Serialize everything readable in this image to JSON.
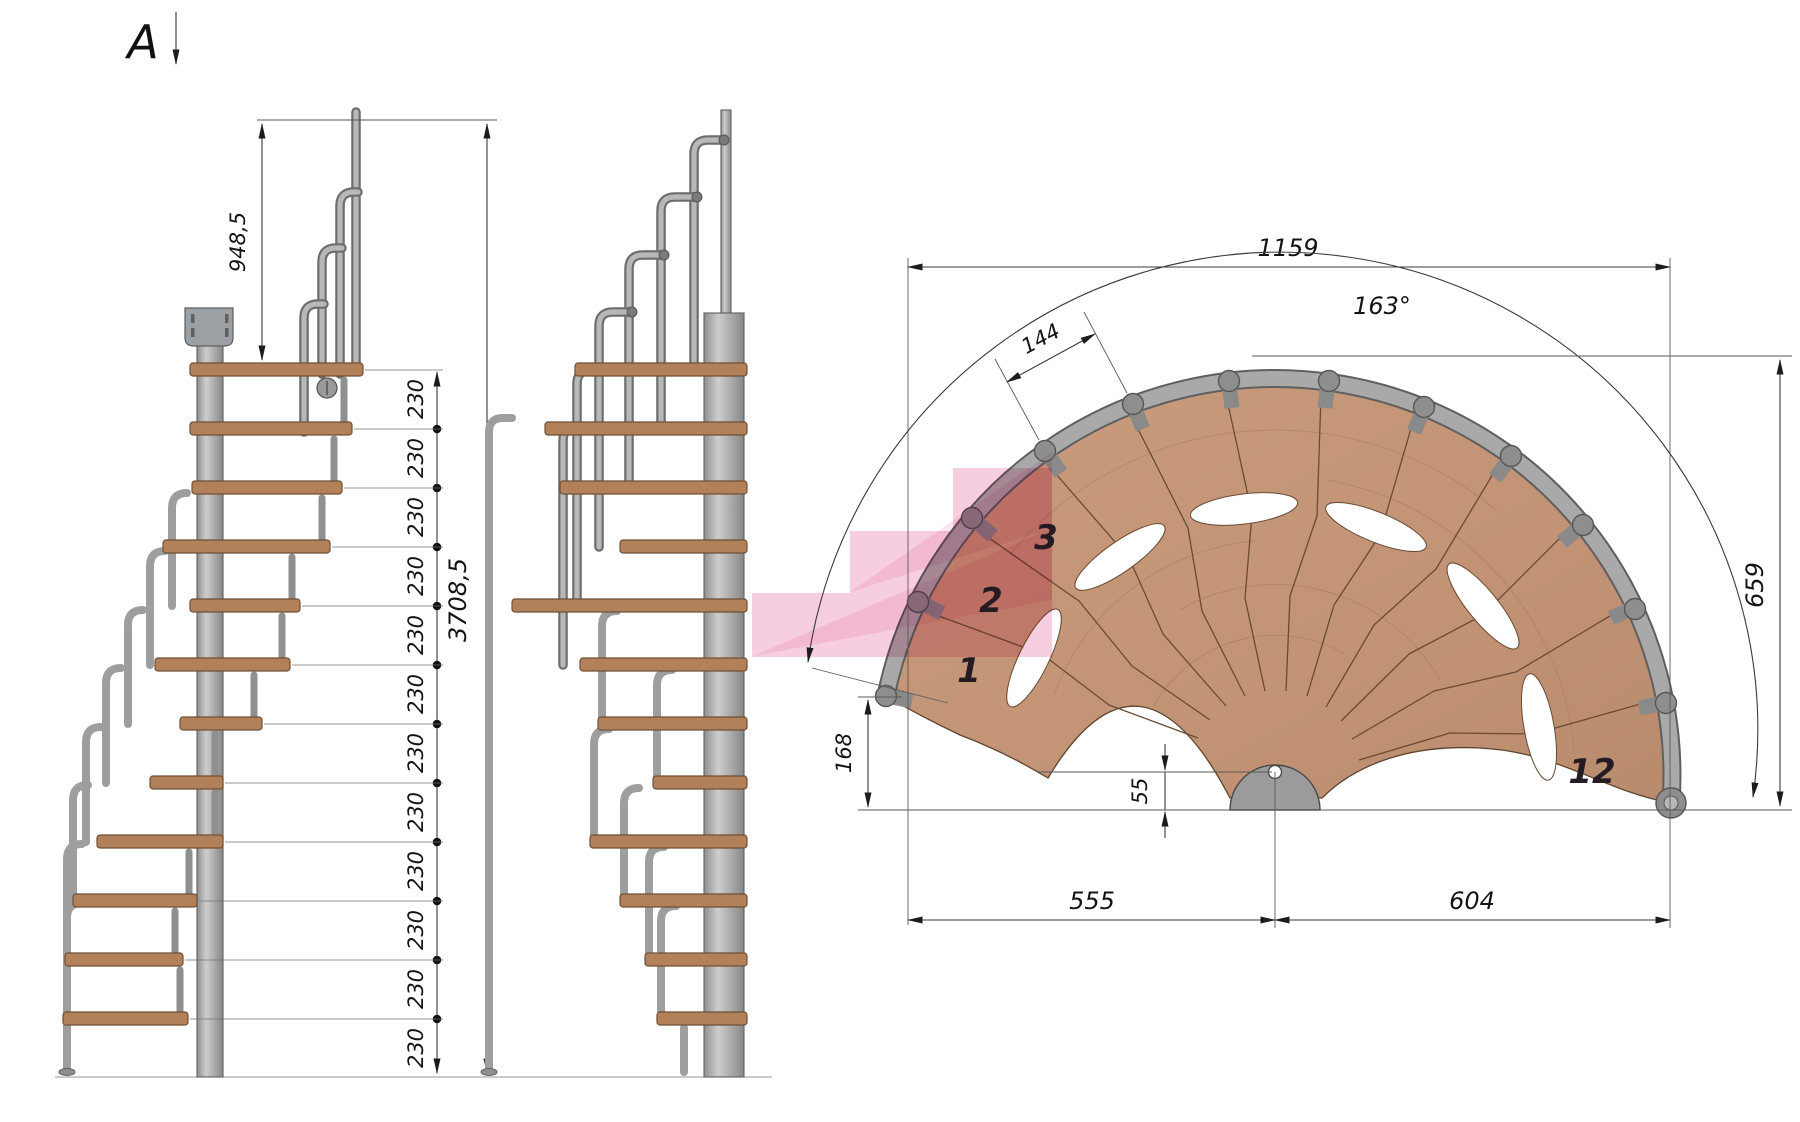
{
  "view_label": {
    "letter": "A"
  },
  "side_view": {
    "handrail_height": "948,5",
    "total_height": "3708,5",
    "step_rise": "230",
    "rise_labels": [
      "230",
      "230",
      "230",
      "230",
      "230",
      "230",
      "230",
      "230",
      "230",
      "230",
      "230",
      "230"
    ]
  },
  "plan_view": {
    "overall_width": "1159",
    "total_angle": "163°",
    "tread_outer_width": "144",
    "depth_right": "659",
    "entry_offset": "168",
    "pole_offset": "55",
    "span_left": "555",
    "span_right": "604",
    "steps": {
      "first": "1",
      "second": "2",
      "third": "3",
      "twelfth": "12"
    }
  },
  "colors": {
    "wood_plan": "#c59877",
    "wood_side": "#b2815a",
    "metal": "#a6a6a6",
    "highlight_pink": "#f1a3c7",
    "line": "#3a3a3a"
  }
}
